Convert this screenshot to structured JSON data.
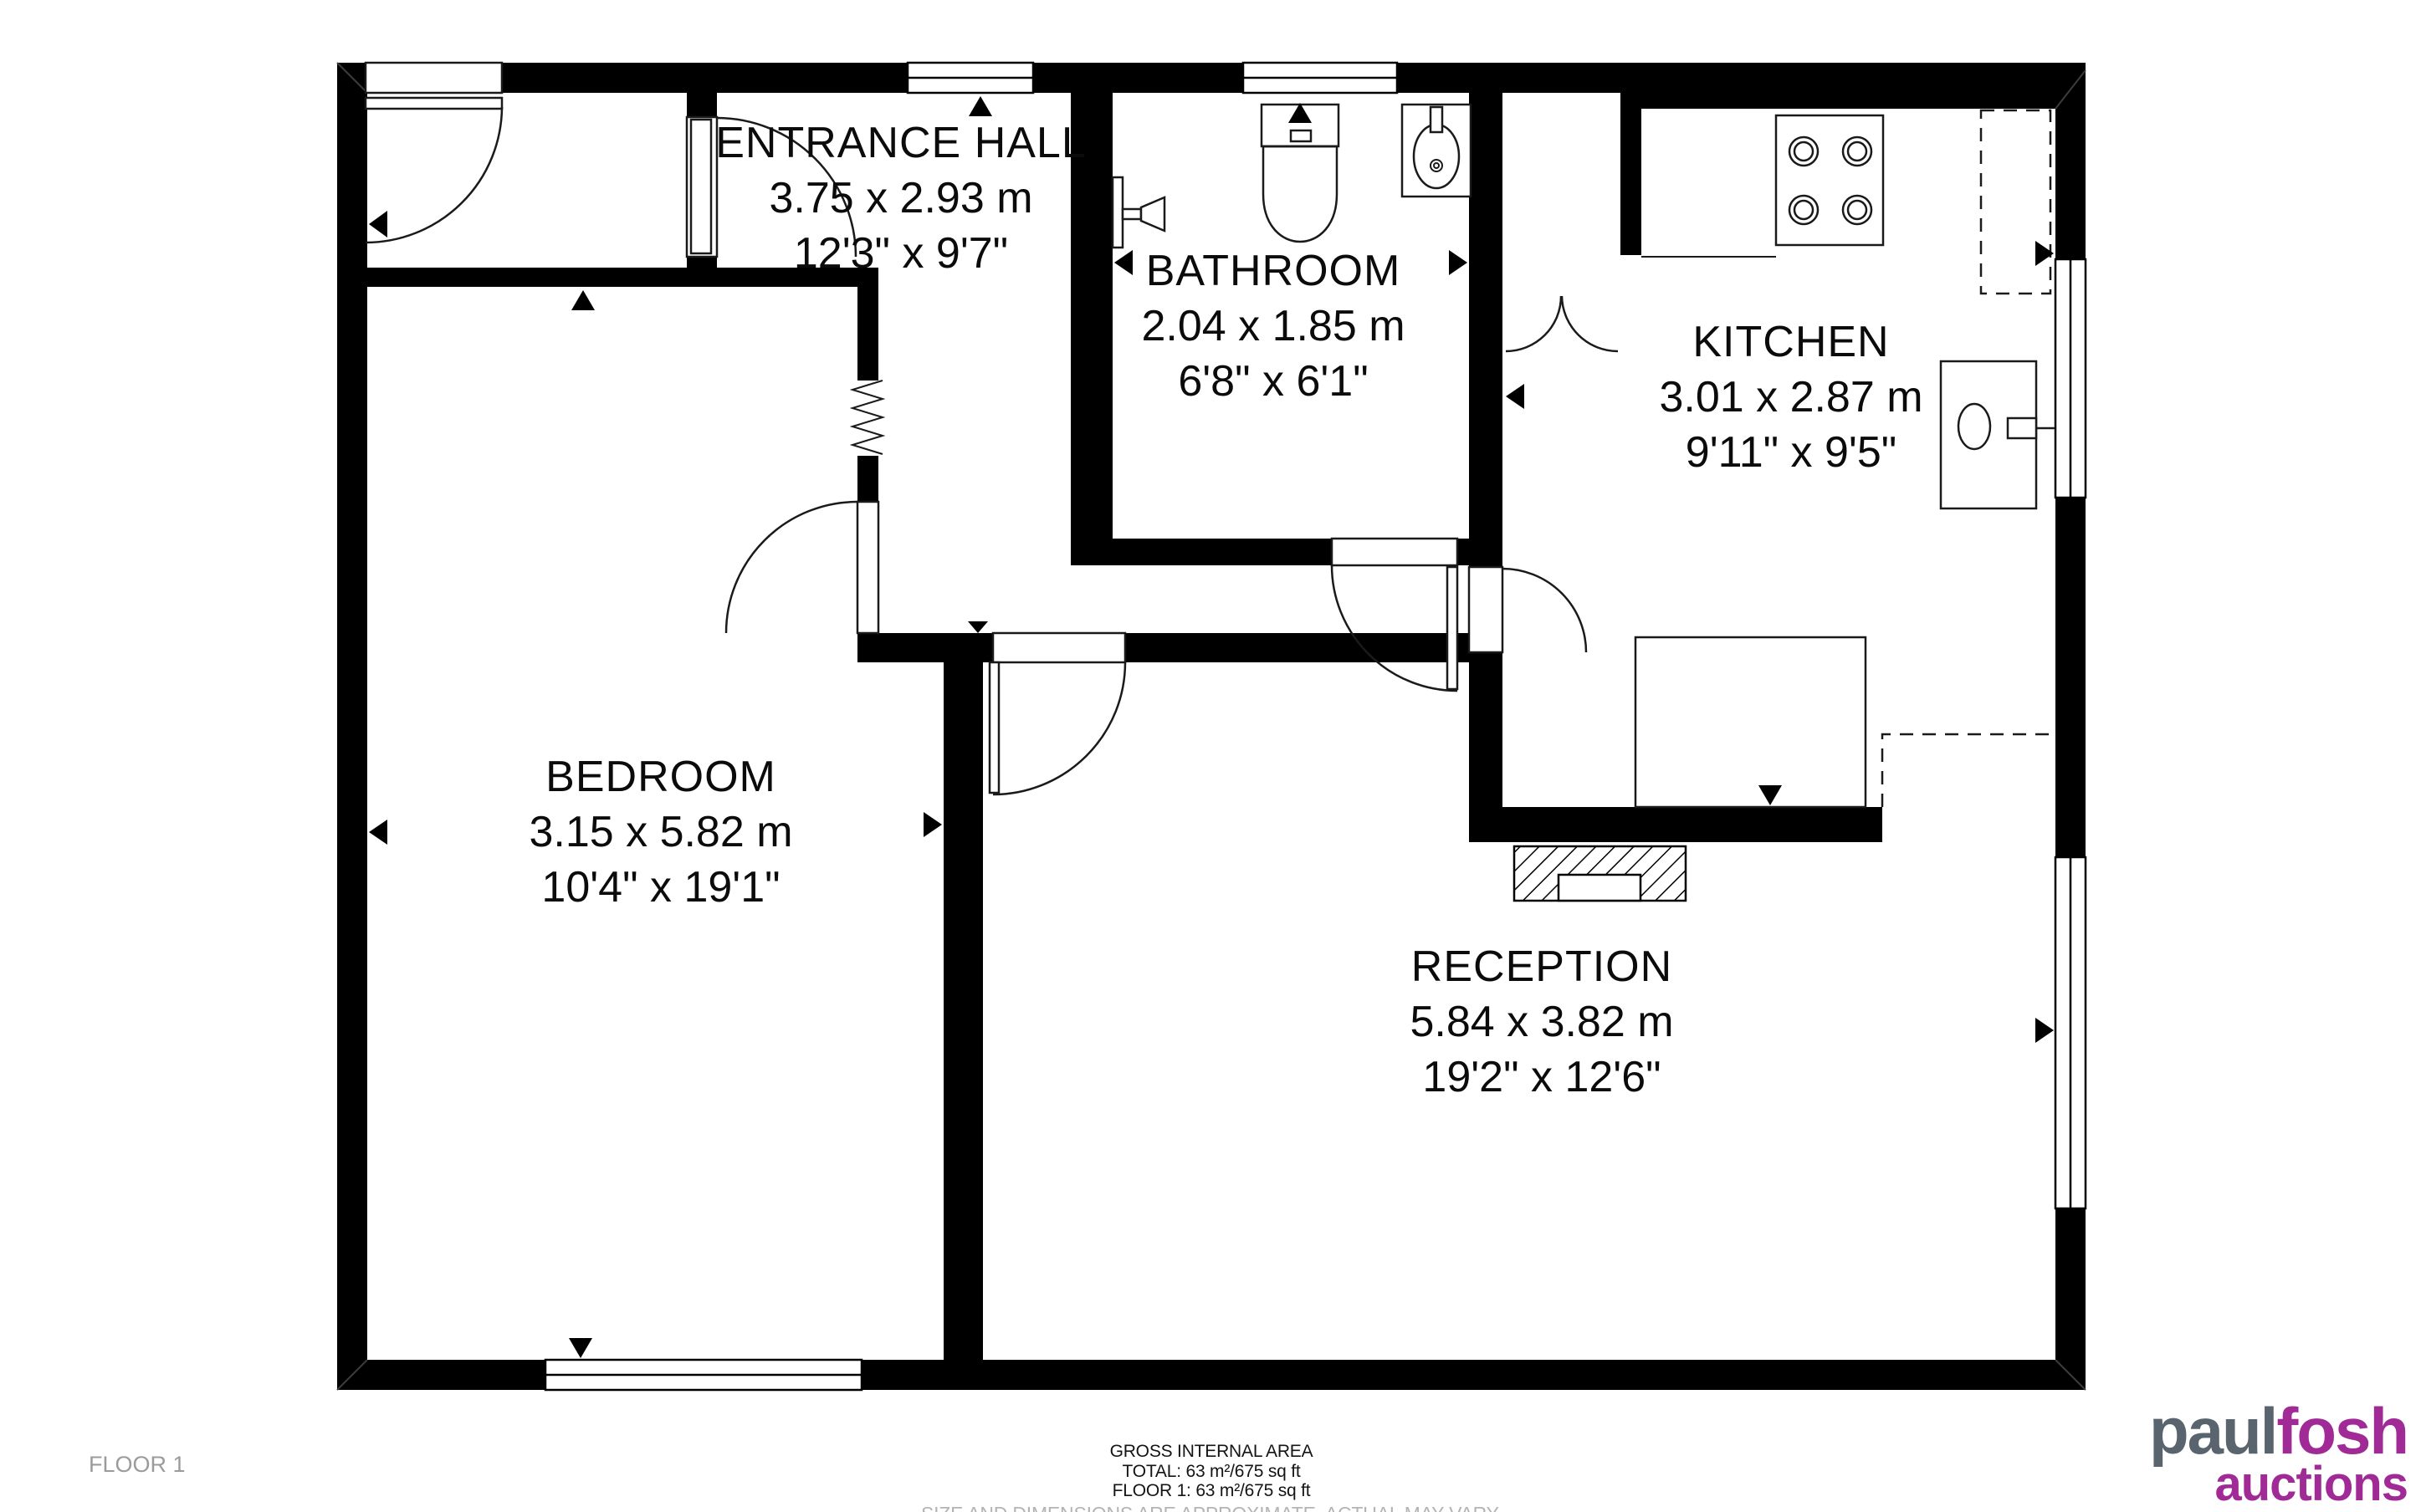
{
  "rooms": {
    "entrance_hall": {
      "name": "ENTRANCE HALL",
      "metric": "3.75 x 2.93 m",
      "imperial": "12'3\" x 9'7\""
    },
    "bathroom": {
      "name": "BATHROOM",
      "metric": "2.04 x 1.85 m",
      "imperial": "6'8\" x 6'1\""
    },
    "kitchen": {
      "name": "KITCHEN",
      "metric": "3.01 x 2.87 m",
      "imperial": "9'11\" x 9'5\""
    },
    "bedroom": {
      "name": "BEDROOM",
      "metric": "3.15 x 5.82 m",
      "imperial": "10'4\" x 19'1\""
    },
    "reception": {
      "name": "RECEPTION",
      "metric": "5.84 x 3.82 m",
      "imperial": "19'2\" x 12'6\""
    }
  },
  "footer": {
    "floor_label": "FLOOR 1",
    "title": "GROSS INTERNAL AREA",
    "total_line": "TOTAL: 63 m²/675 sq ft",
    "floor_line": "FLOOR 1: 63 m²/675 sq ft",
    "disclaimer": "SIZE AND DIMENSIONS ARE APPROXIMATE, ACTUAL MAY VARY."
  },
  "logo": {
    "part1": "paul",
    "part2": "fosh",
    "sub": "auctions"
  },
  "colors": {
    "wall": "#000000",
    "line": "#1a1a1a",
    "logo_gray": "#5a646e",
    "logo_magenta": "#a02a96",
    "muted_text": "#9b9b9b",
    "disclaimer_text": "#b4b4b4"
  }
}
